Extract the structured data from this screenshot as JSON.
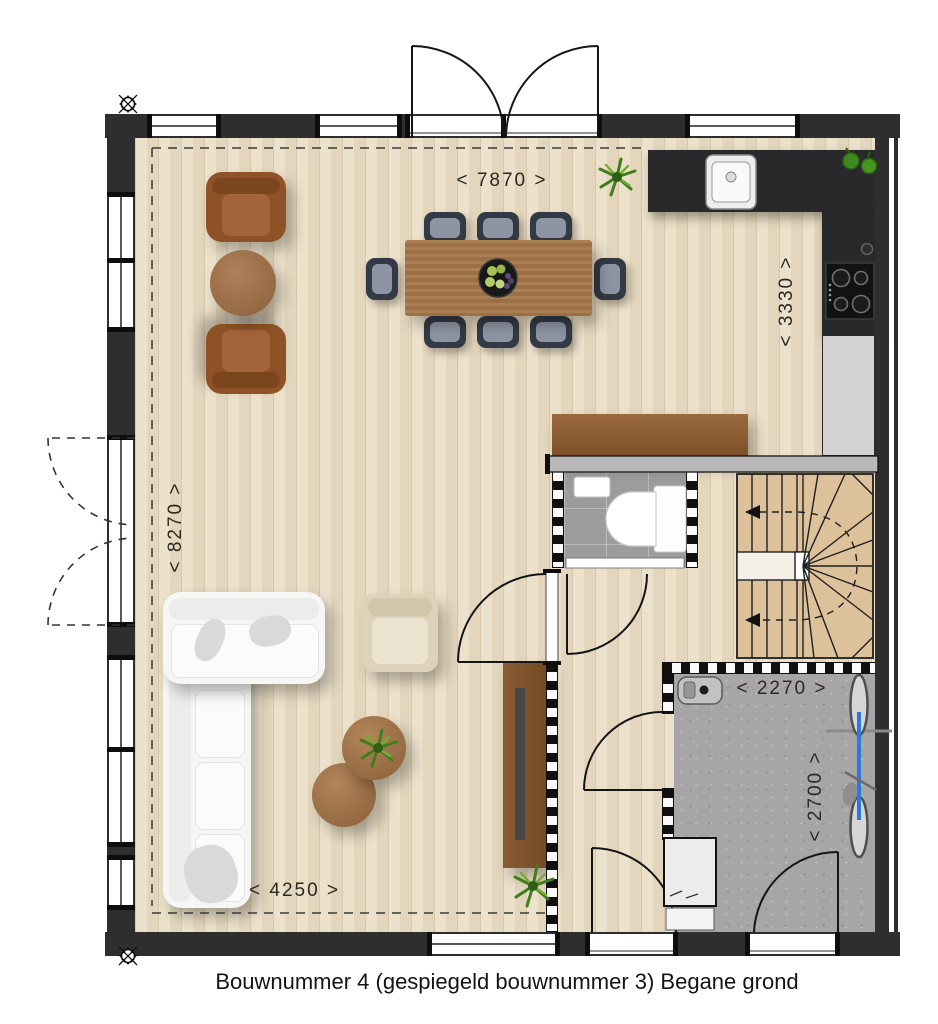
{
  "caption": "Bouwnummer 4 (gespiegeld bouwnummer 3) Begane grond",
  "dimensions": {
    "top_width": "< 7870 >",
    "kitchen_depth": "< 3330 >",
    "left_depth": "< 8270 >",
    "bottom_width": "< 4250 >",
    "storage_width": "< 2270 >",
    "storage_depth": "< 2700 >"
  },
  "colors": {
    "wood_floor": "#e8dcc5",
    "kitchen_counter": "#29292b",
    "storage_floor": "#a8a5a8",
    "toilet_floor": "#9c9c9c",
    "stair_tread": "#dcc19a",
    "sofa": "#f6f6f5",
    "leather_chair": "#8e5226",
    "wood_furniture": "#9b7046",
    "bike": "#2b7bd4",
    "plant": "#3f7d1d",
    "wall": "#2e2e2e"
  }
}
